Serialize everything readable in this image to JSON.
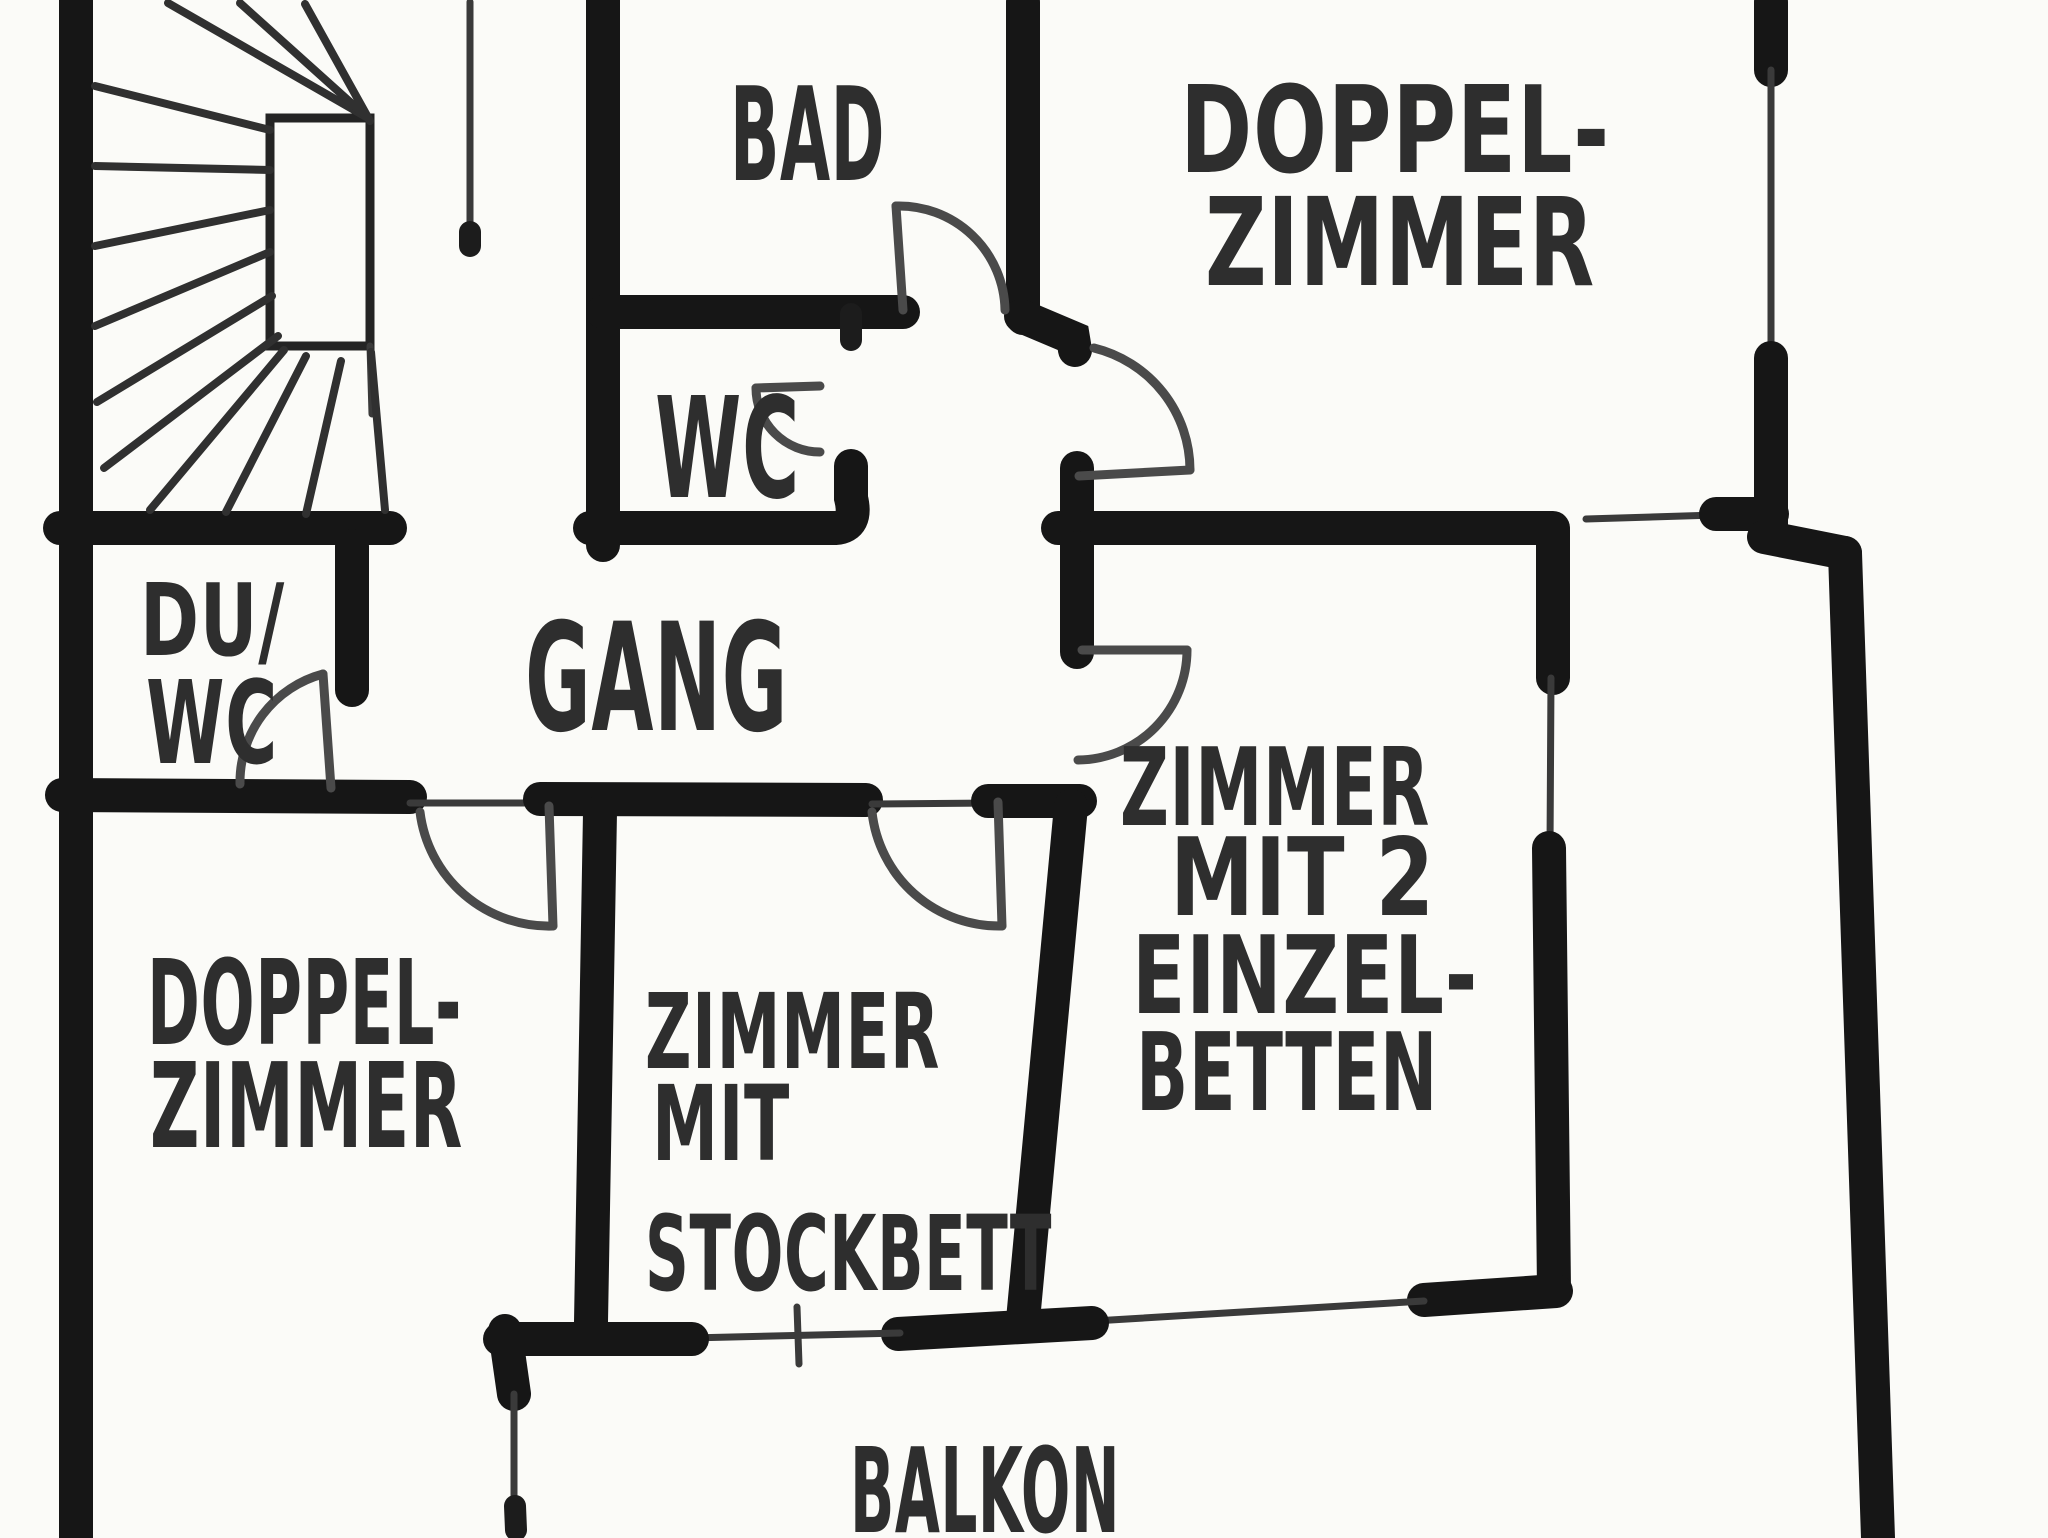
{
  "document": {
    "type": "hand-drawn floor plan (scanned, black marker on white paper)",
    "language": "German"
  },
  "colors": {
    "background": "#fbfbf8",
    "wall_ink": "#161616",
    "text_ink": "#2e2e2e",
    "thin_line": "#3a3a3a",
    "door_line": "#4a4a4a"
  },
  "rooms": [
    {
      "id": "bad",
      "label": [
        "BAD"
      ]
    },
    {
      "id": "doppelzimmer_top",
      "label": [
        "DOPPEL-",
        "ZIMMER"
      ]
    },
    {
      "id": "wc",
      "label": [
        "WC"
      ]
    },
    {
      "id": "du_wc",
      "label": [
        "DU/",
        "WC"
      ]
    },
    {
      "id": "gang",
      "label": [
        "GANG"
      ]
    },
    {
      "id": "zimmer_mit_2_einzelbetten",
      "label": [
        "ZIMMER",
        "MIT 2",
        "EINZEL-",
        "BETTEN"
      ]
    },
    {
      "id": "doppelzimmer_bottom",
      "label": [
        "DOPPEL-",
        "ZIMMER"
      ]
    },
    {
      "id": "zimmer_mit_stockbett",
      "label": [
        "ZIMMER",
        "MIT",
        "STOCKBETT"
      ]
    },
    {
      "id": "balkon",
      "label": [
        "BALKON"
      ]
    }
  ],
  "features": {
    "staircase": "winder-staircase-top-left",
    "doors": "quarter-circle door swing arcs",
    "windows": "thin lines between thick wall segments",
    "balcony_railing": "thin line with end posts"
  }
}
